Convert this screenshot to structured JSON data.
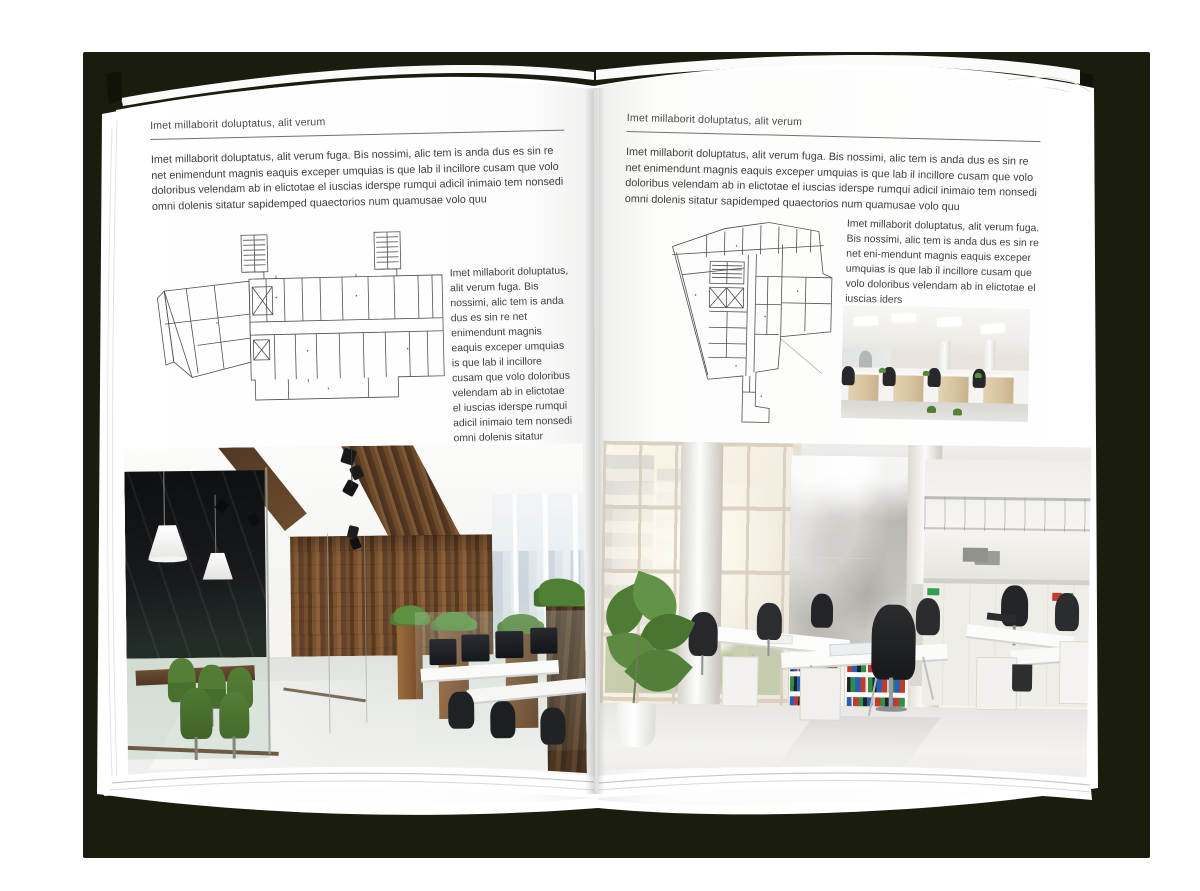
{
  "book": {
    "left_page": {
      "header": "Imet millaborit doluptatus, alit verum",
      "intro": "Imet millaborit doluptatus, alit verum fuga. Bis nossimi, alic tem is anda dus es sin re net enimendunt magnis eaquis exceper umquias is que lab il incillore cusam que volo doloribus velendam ab in elictotae el iuscias iderspe rumqui adicil inimaio tem nonsedi omni dolenis sitatur sapidemped quaectorios num quamusae volo quu",
      "plan_caption": "Imet millaborit doluptatus, alit verum fuga. Bis nossimi, alic tem is anda dus es sin re net enimendunt magnis eaquis exceper umquias is que lab il incillore cusam que volo doloribus velendam ab in elictotae el iuscias iderspe rumqui adicil inimaio tem nonsedi omni dolenis sitatur sapidemped quaectorios num quamusae volo quu"
    },
    "right_page": {
      "header": "Imet millaborit doluptatus, alit verum",
      "intro": "Imet millaborit doluptatus, alit verum fuga. Bis nossimi, alic tem is anda dus es sin re net enimendunt magnis eaquis exceper umquias is que lab il incillore cusam que volo doloribus velendam ab in elictotae el iuscias iderspe rumqui adicil inimaio tem nonsedi omni dolenis sitatur sapidemped quaectorios num quamusae volo quu",
      "plan_caption": "Imet millaborit doluptatus, alit verum fuga. Bis nossimi, alic tem is anda dus es sin re net eni-mendunt magnis eaquis exceper umquias is que lab il incillore cusam que volo doloribus velendam ab in elictotae el iuscias iders"
    }
  },
  "images": {
    "left_floor_plan": "architectural floor plan of elongated office building with two stair towers",
    "right_floor_plan": "architectural floor plan of irregular-shaped office building",
    "left_photo": "office interior with dark glass meeting room, green chairs, wooden wall and planters",
    "right_photo_small": "open-plan office with white ceiling, desk rows and light wood cabinets",
    "right_photo_large": "bright atrium office with tall windows, concrete wall, bookshelves and white desks"
  },
  "colors": {
    "backdrop": "#1a1c0e",
    "page": "#ffffff",
    "body_text": "#3e3e3e",
    "rule": "#707070",
    "plan_line": "#4f4f4f",
    "wood": "#6b4a2c",
    "chair_green": "#4f7c35",
    "binder_blue": "#2a5fb4",
    "binder_red": "#c03a2d",
    "binder_green": "#2f8f46"
  }
}
